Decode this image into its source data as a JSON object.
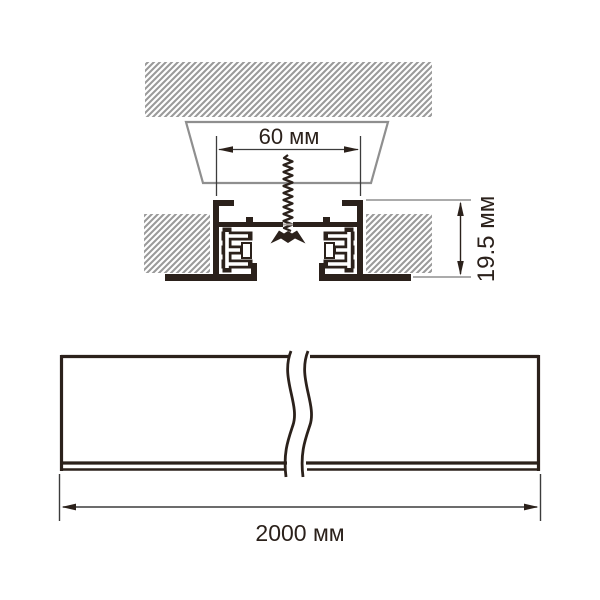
{
  "labels": {
    "recess_width": "60 мм",
    "profile_height": "19.5 мм",
    "profile_length": "2000 мм"
  },
  "colors": {
    "line": "#2b211b",
    "thin_line": "#3c3c3c",
    "hatch": "#9a9a9a",
    "cavity_outline": "#8f8f8f",
    "hole_highlight": "#b0a9a4",
    "background": "#ffffff"
  }
}
